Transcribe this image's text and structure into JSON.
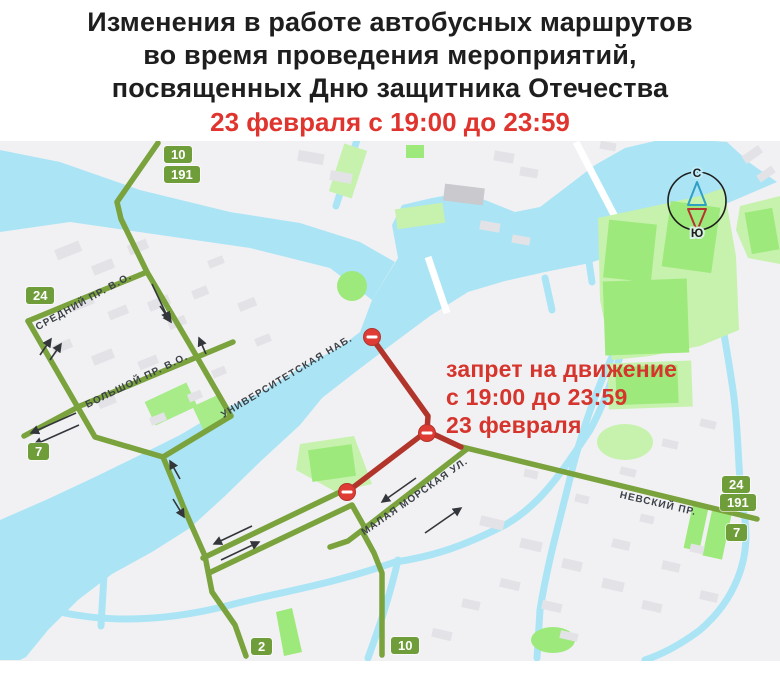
{
  "poster": {
    "title_lines": [
      "Изменения в работе автобусных маршрутов",
      "во время проведения мероприятий,",
      "посвященных Дню защитника Отечества"
    ],
    "subtitle": "23 февраля с 19:00 до 23:59"
  },
  "map": {
    "annotation": {
      "lines": [
        "запрет на движение",
        "с 19:00 до 23:59",
        "23 февраля"
      ]
    },
    "street_labels": [
      {
        "id": "sredniy",
        "text": "СРЕДНИЙ ПР. В.О."
      },
      {
        "id": "bolshoy",
        "text": "БОЛЬШОЙ ПР. В.О."
      },
      {
        "id": "universitetskaya",
        "text": "УНИВЕРСИТЕТСКАЯ НАБ."
      },
      {
        "id": "malaya-morskaya",
        "text": "МАЛАЯ МОРСКАЯ УЛ."
      },
      {
        "id": "nevsky",
        "text": "НЕВСКИЙ ПР."
      }
    ],
    "route_badges": [
      {
        "id": "top-10",
        "number": "10"
      },
      {
        "id": "top-191",
        "number": "191"
      },
      {
        "id": "left-24",
        "number": "24"
      },
      {
        "id": "left-7",
        "number": "7"
      },
      {
        "id": "right-24",
        "number": "24"
      },
      {
        "id": "right-191",
        "number": "191"
      },
      {
        "id": "right-7",
        "number": "7"
      },
      {
        "id": "bottom-2",
        "number": "2"
      },
      {
        "id": "bottom-10",
        "number": "10"
      }
    ],
    "compass": {
      "north_label": "С",
      "south_label": "Ю"
    },
    "colors": {
      "route_green": "#7aa23d",
      "badge_green": "#6f9d3a",
      "route_red": "#b2352c",
      "no_entry_red": "#de3c35",
      "annotation_red": "#d5352d",
      "title_red": "#e0342e",
      "water": "#abe5f5",
      "land": "#f1f1f3",
      "park_pale": "#c6f2ad",
      "park_vivid": "#9ee97c"
    }
  }
}
